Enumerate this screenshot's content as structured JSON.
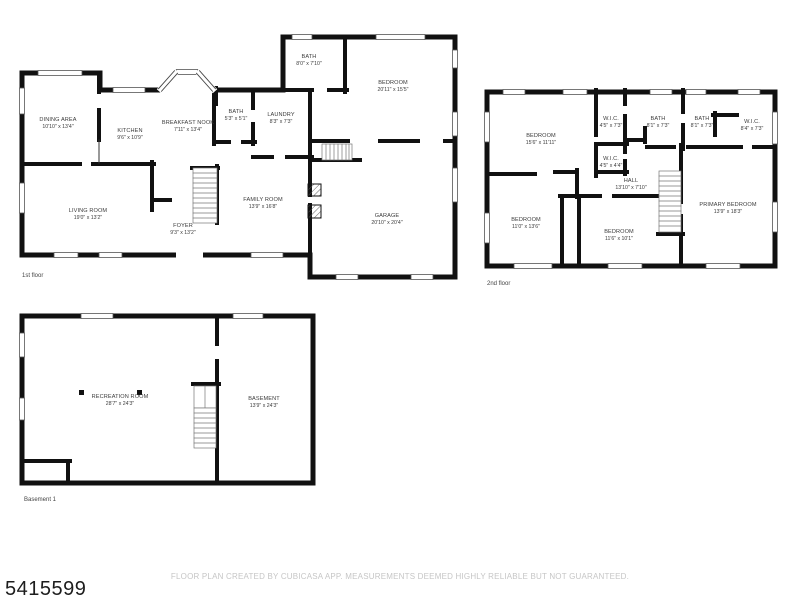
{
  "document": {
    "listing_id": "5415599",
    "disclaimer": "FLOOR PLAN CREATED BY CUBICASA APP. MEASUREMENTS DEEMED HIGHLY RELIABLE BUT NOT GUARANTEED."
  },
  "colors": {
    "wall": "#111111",
    "room_text": "#3c3c3c",
    "floor_label_text": "#444444",
    "disclaimer_text": "#c6c6c6",
    "id_text": "#1d1d1d",
    "background": "#ffffff"
  },
  "floors": [
    {
      "label": "1st floor",
      "rooms": [
        {
          "name": "DINING AREA",
          "dims": "10'10\" x 13'4\""
        },
        {
          "name": "KITCHEN",
          "dims": "9'6\" x 10'9\""
        },
        {
          "name": "BREAKFAST NOOK",
          "dims": "7'11\" x 13'4\""
        },
        {
          "name": "BATH",
          "dims": "5'3\" x 5'1\""
        },
        {
          "name": "LAUNDRY",
          "dims": "8'3\" x 7'3\""
        },
        {
          "name": "BATH",
          "dims": "8'0\" x 7'10\""
        },
        {
          "name": "BEDROOM",
          "dims": "20'11\" x 15'5\""
        },
        {
          "name": "LIVING ROOM",
          "dims": "19'0\" x 13'2\""
        },
        {
          "name": "FOYER",
          "dims": "9'3\" x 13'2\""
        },
        {
          "name": "FAMILY ROOM",
          "dims": "13'9\" x 16'8\""
        },
        {
          "name": "GARAGE",
          "dims": "20'10\" x 20'4\""
        }
      ]
    },
    {
      "label": "2nd floor",
      "rooms": [
        {
          "name": "BEDROOM",
          "dims": "15'6\" x 11'11\""
        },
        {
          "name": "W.I.C.",
          "dims": "4'5\" x 7'3\""
        },
        {
          "name": "BATH",
          "dims": "8'1\" x 7'3\""
        },
        {
          "name": "BATH",
          "dims": "8'1\" x 7'3\""
        },
        {
          "name": "W.I.C.",
          "dims": "8'4\" x 7'3\""
        },
        {
          "name": "W.I.C.",
          "dims": "4'5\" x 4'4\""
        },
        {
          "name": "HALL",
          "dims": "13'10\" x 7'10\""
        },
        {
          "name": "BEDROOM",
          "dims": "11'0\" x 13'6\""
        },
        {
          "name": "BEDROOM",
          "dims": "11'6\" x 10'1\""
        },
        {
          "name": "PRIMARY BEDROOM",
          "dims": "13'9\" x 18'3\""
        }
      ]
    },
    {
      "label": "Basement 1",
      "rooms": [
        {
          "name": "RECREATION ROOM",
          "dims": "28'7\" x 24'3\""
        },
        {
          "name": "BASEMENT",
          "dims": "13'9\" x 24'3\""
        }
      ]
    }
  ]
}
